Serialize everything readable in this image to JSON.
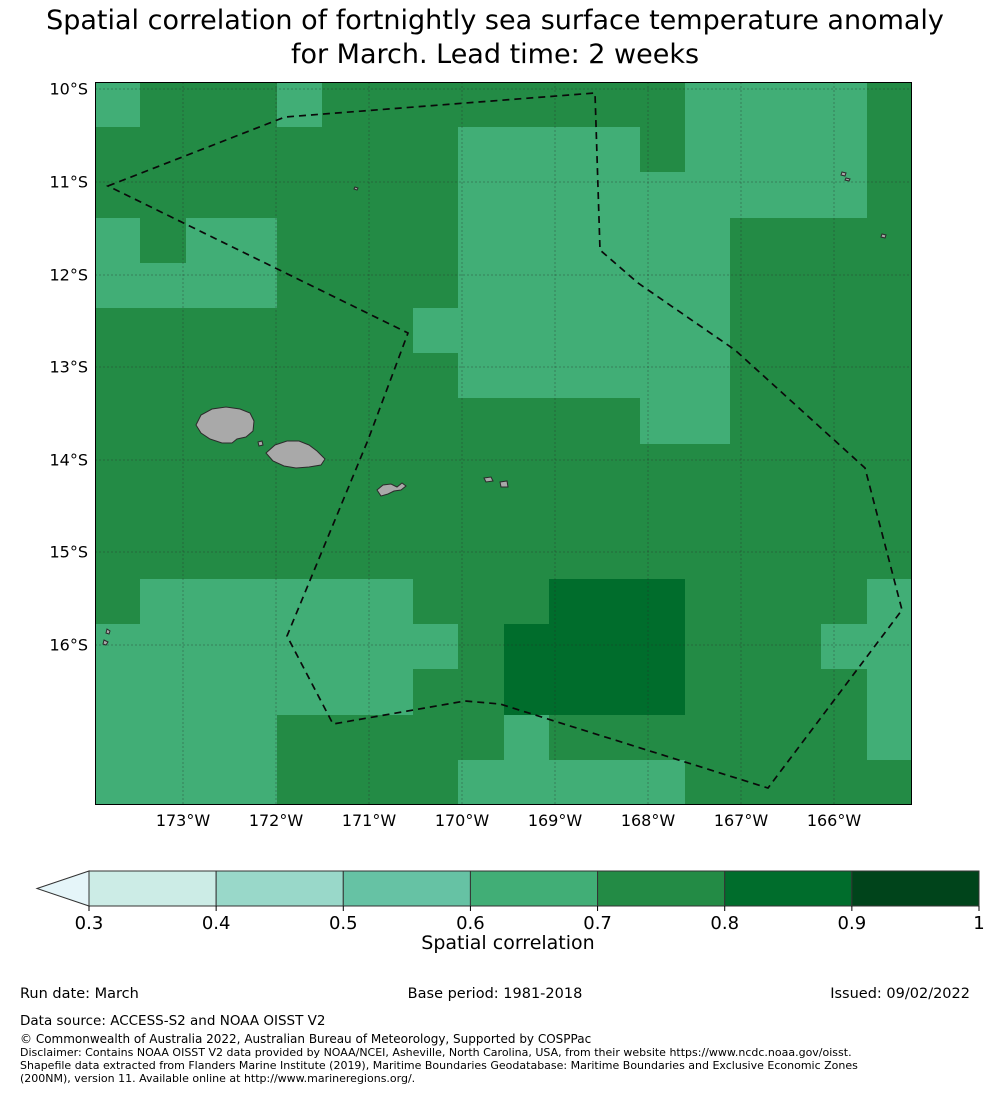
{
  "title": {
    "line1": "Spatial correlation of fortnightly sea surface temperature anomaly",
    "line2": "for March. Lead time: 2 weeks"
  },
  "chart_data": {
    "type": "heatmap",
    "title": "Spatial correlation of fortnightly sea surface temperature anomaly for March. Lead time: 2 weeks",
    "variable": "Spatial correlation",
    "lon_ticks": [
      "173°W",
      "172°W",
      "171°W",
      "170°W",
      "169°W",
      "168°W",
      "167°W",
      "166°W"
    ],
    "lat_ticks": [
      "10°S",
      "11°S",
      "12°S",
      "13°S",
      "14°S",
      "15°S",
      "16°S"
    ],
    "lon_range_deg_west": [
      174.0,
      165.1
    ],
    "lat_range_deg_south": [
      9.9,
      17.7
    ],
    "cell_size_deg": 0.5,
    "bins": {
      "l": "0.6-0.7",
      ".": "0.7-0.8",
      "k": "0.8-0.9"
    },
    "grid_rows": [
      "l...l........llll.",
      "........llll.llll.",
      "........lllllllll.",
      "l.ll....llllll....",
      "llll....llllll....",
      ".......lllllll....",
      "........llllll....",
      "............ll....",
      "..................",
      "..................",
      "..................",
      ".llllll...kkk....l",
      "llllllll.kkkk...ll",
      "lllllll..kkkk....l",
      "llll.....l.......l",
      "llll....lllll....."
    ],
    "colorbar": {
      "label": "Spatial correlation",
      "tick_labels": [
        "0.3",
        "0.4",
        "0.5",
        "0.6",
        "0.7",
        "0.8",
        "0.9",
        "1"
      ],
      "segment_colors": [
        "#ccece6",
        "#99d8c9",
        "#66c2a4",
        "#41ae76",
        "#238b45",
        "#006d2c",
        "#00441b"
      ],
      "extend_under_color": "#e5f5f9"
    }
  },
  "map": {
    "bin_colors": {
      "l": "#41ae76",
      ".": "#238b45",
      "k": "#006d2c"
    },
    "xticks": [
      {
        "label": "173°W",
        "x": 183
      },
      {
        "label": "172°W",
        "x": 276
      },
      {
        "label": "171°W",
        "x": 369
      },
      {
        "label": "170°W",
        "x": 462
      },
      {
        "label": "169°W",
        "x": 555
      },
      {
        "label": "168°W",
        "x": 648
      },
      {
        "label": "167°W",
        "x": 741
      },
      {
        "label": "166°W",
        "x": 834
      }
    ],
    "yticks": [
      {
        "label": "10°S",
        "y": 89
      },
      {
        "label": "11°S",
        "y": 182
      },
      {
        "label": "12°S",
        "y": 275
      },
      {
        "label": "13°S",
        "y": 367
      },
      {
        "label": "14°S",
        "y": 460
      },
      {
        "label": "15°S",
        "y": 552
      },
      {
        "label": "16°S",
        "y": 645
      }
    ],
    "eez_boundary_points": "108,186 285,117 595,93 600,250 638,283 735,350 865,468 902,610 768,788 500,704 465,701 333,724 287,636 368,440 408,333",
    "island_fill": "#a9a9a9",
    "island_stroke": "#2b2b2b",
    "islands": [
      {
        "name": "savaii",
        "points": "196,425 201,415 212,409 226,407 240,409 250,413 254,421 253,431 246,437 237,439 232,443 222,443 210,439 201,433"
      },
      {
        "name": "upolu",
        "points": "266,453 275,445 287,441 299,441 309,445 317,451 325,459 321,465 309,467 296,468 284,466 273,461"
      },
      {
        "name": "manono",
        "points": "258,442 262,441 263,445 259,446"
      },
      {
        "name": "tutuila",
        "points": "377,490 383,485 391,484 397,487 402,483 406,486 401,490 394,491 388,494 381,496"
      },
      {
        "name": "ofu-olosega",
        "points": "484,478 491,477 493,481 486,482"
      },
      {
        "name": "tau",
        "points": "500,482 507,481 508,487 501,487"
      },
      {
        "name": "tafahi",
        "points": "107,629 110,631 109,634 106,633"
      },
      {
        "name": "reef-16s",
        "points": "104,640 108,642 106,645 103,644"
      },
      {
        "name": "speck-171w",
        "points": "355,187 358,188 357,190 354,189"
      },
      {
        "name": "speck-166w-a",
        "points": "842,172 846,173 845,176 841,175"
      },
      {
        "name": "speck-166w-b",
        "points": "846,178 850,179 849,181 845,180"
      },
      {
        "name": "speck-165w",
        "points": "882,234 886,235 885,238 881,237"
      }
    ]
  },
  "footer": {
    "run_date": "Run date: March",
    "base_period": "Base period: 1981-2018",
    "issued": "Issued: 09/02/2022",
    "data_source": "Data source: ACCESS-S2 and NOAA OISST V2",
    "copyright": "© Commonwealth of Australia 2022, Australian Bureau of Meteorology, Supported by COSPPac",
    "disclaimer1": "Disclaimer: Contains NOAA OISST V2 data provided by NOAA/NCEI, Asheville, North Carolina, USA, from their website https://www.ncdc.noaa.gov/oisst.",
    "disclaimer2": "Shapefile data extracted from Flanders Marine Institute (2019), Maritime Boundaries Geodatabase: Maritime Boundaries and Exclusive Economic Zones",
    "disclaimer3": "(200NM), version 11. Available online at http://www.marineregions.org/."
  }
}
